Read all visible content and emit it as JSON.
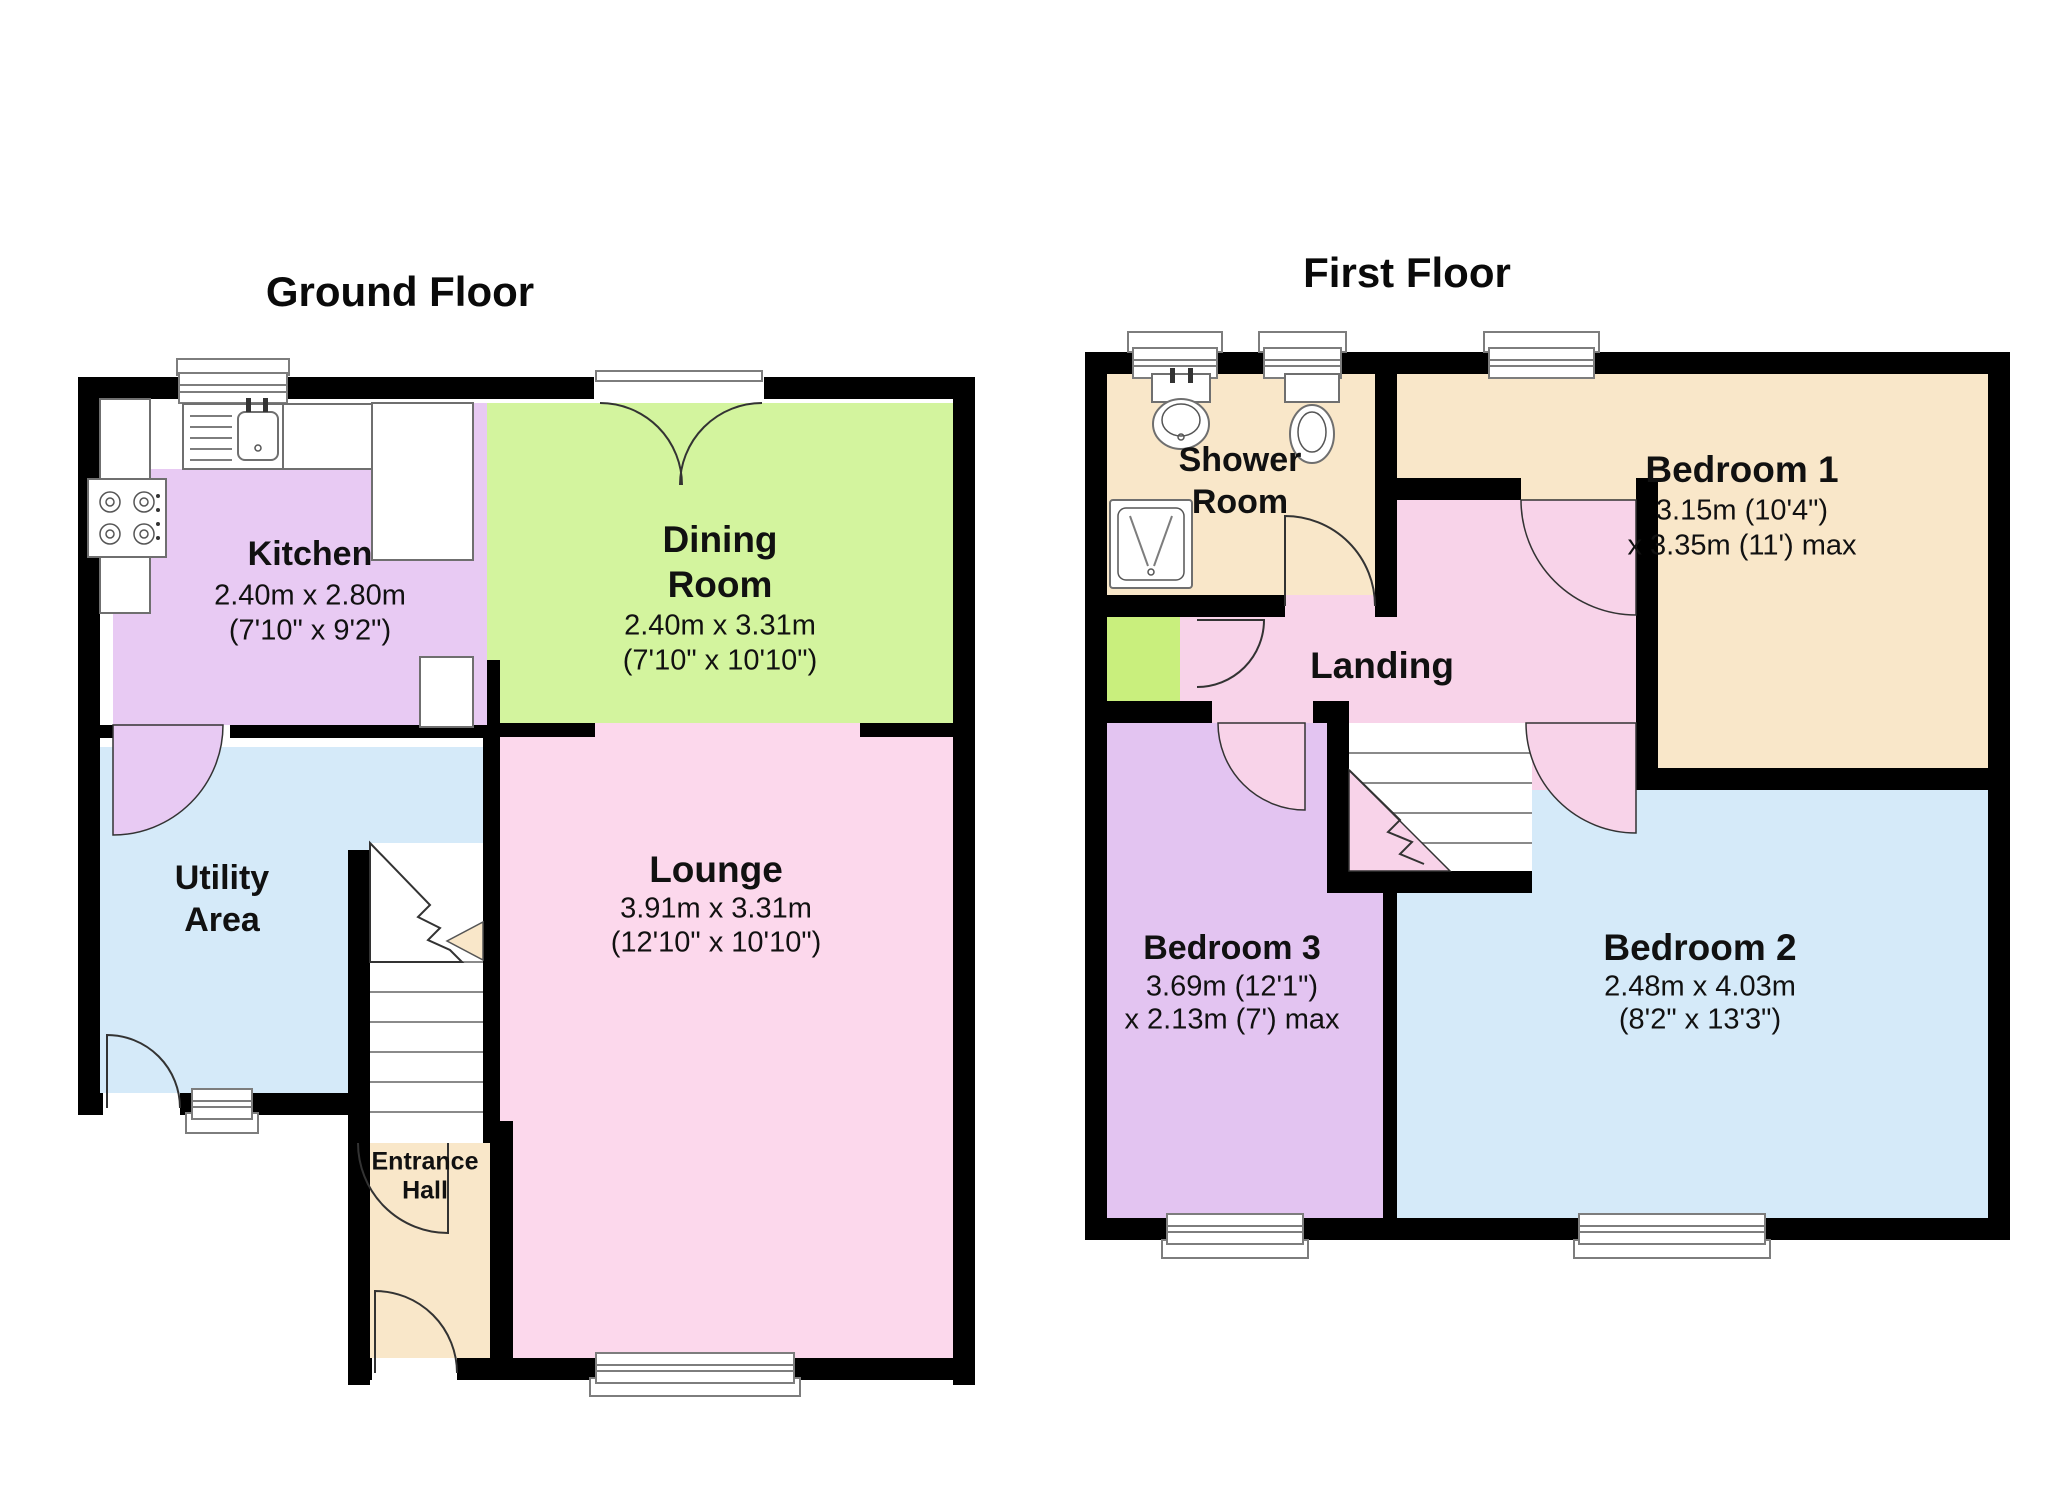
{
  "colors": {
    "kitchen": "#e8caf3",
    "dining": "#d3f49e",
    "utility": "#d5eaf9",
    "lounge": "#fcd8ec",
    "cream": "#f9e7c9",
    "landing": "#f8d3e9",
    "bedroom3": "#e3c4f1",
    "bedroom2": "#d5eaf9",
    "cupboard": "#c9ef7d",
    "wall": "#000000"
  },
  "ground_floor": {
    "title": "Ground Floor",
    "rooms": {
      "kitchen": {
        "name": "Kitchen",
        "dim1": "2.40m x 2.80m",
        "dim2": "(7'10\" x 9'2\")"
      },
      "dining": {
        "name1": "Dining",
        "name2": "Room",
        "dim1": "2.40m x 3.31m",
        "dim2": "(7'10\" x 10'10\")"
      },
      "utility": {
        "name1": "Utility",
        "name2": "Area"
      },
      "lounge": {
        "name": "Lounge",
        "dim1": "3.91m x 3.31m",
        "dim2": "(12'10\" x 10'10\")"
      },
      "entrance": {
        "name1": "Entrance",
        "name2": "Hall"
      }
    }
  },
  "first_floor": {
    "title": "First Floor",
    "rooms": {
      "shower": {
        "name1": "Shower",
        "name2": "Room"
      },
      "bedroom1": {
        "name": "Bedroom 1",
        "dim1": "3.15m (10'4\")",
        "dim2": "x 3.35m (11') max"
      },
      "landing": {
        "name": "Landing"
      },
      "bedroom3": {
        "name": "Bedroom 3",
        "dim1": "3.69m (12'1\")",
        "dim2": "x 2.13m (7') max"
      },
      "bedroom2": {
        "name": "Bedroom 2",
        "dim1": "2.48m x 4.03m",
        "dim2": "(8'2\" x 13'3\")"
      }
    }
  }
}
